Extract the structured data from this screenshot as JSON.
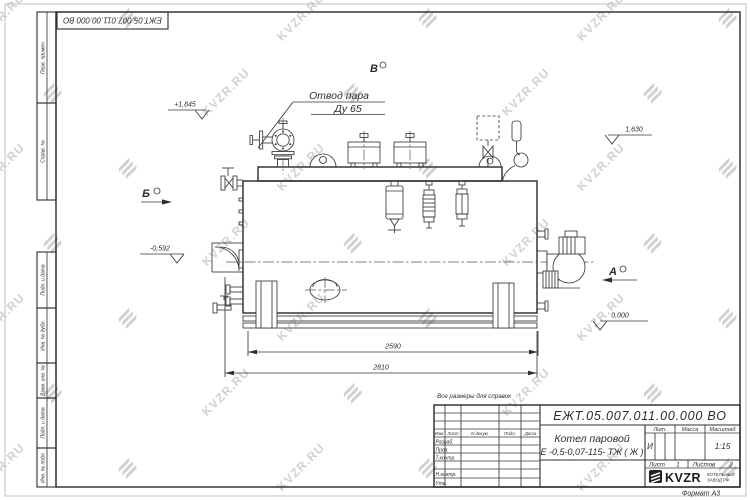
{
  "watermark": {
    "text": "KVZR.RU"
  },
  "frame": {
    "top_stamp": "ЕЖТ.05.007.011.00.000  ВО",
    "reference_note": "Все размеры для справок",
    "format_label": "Формат А3",
    "margin_labels": [
      "Перв. примен.",
      "Справ. №",
      "Подп. и дата",
      "Инв. № дубл.",
      "Взам. инв. №",
      "Подп. и дата",
      "Инв. № подл."
    ]
  },
  "title_block": {
    "doc_number": "ЕЖТ.05.007.011.00.000  ВО",
    "product_name_line1": "Котел паровой",
    "product_name_line2": "Е -0,5-0,07-115- ТЖ ( Ж )",
    "header_cols": {
      "izm": "Изм.",
      "list": "Лист",
      "ndoc": "N докум.",
      "podp": "Подп.",
      "data": "Дата"
    },
    "rows": [
      "Разраб.",
      "Пров.",
      "Т.контр.",
      "Н.контр.",
      "Утв."
    ],
    "lit_label": "Лит.",
    "massa_label": "Масса",
    "masshtab_label": "Масштаб",
    "lit_value": "И",
    "scale_value": "1:15",
    "sheet_label": "Лист",
    "sheet_value": "1",
    "sheets_label": "Листов",
    "sheets_value": "2",
    "company": "KVZR",
    "company_sub1": "КОТЕЛЬНЫЙ",
    "company_sub2": "ЗАВОД РФ"
  },
  "drawing": {
    "callout_line1": "Отвод пара",
    "callout_line2": "Ду 65",
    "dimensions": {
      "d1": "2590",
      "d2": "2810"
    },
    "elevations": {
      "e1": "+1,845",
      "e2": "1,630",
      "e3": "-0,592",
      "e4": "0,000"
    },
    "sections": {
      "a": "А",
      "b": "Б",
      "v": "В"
    }
  }
}
